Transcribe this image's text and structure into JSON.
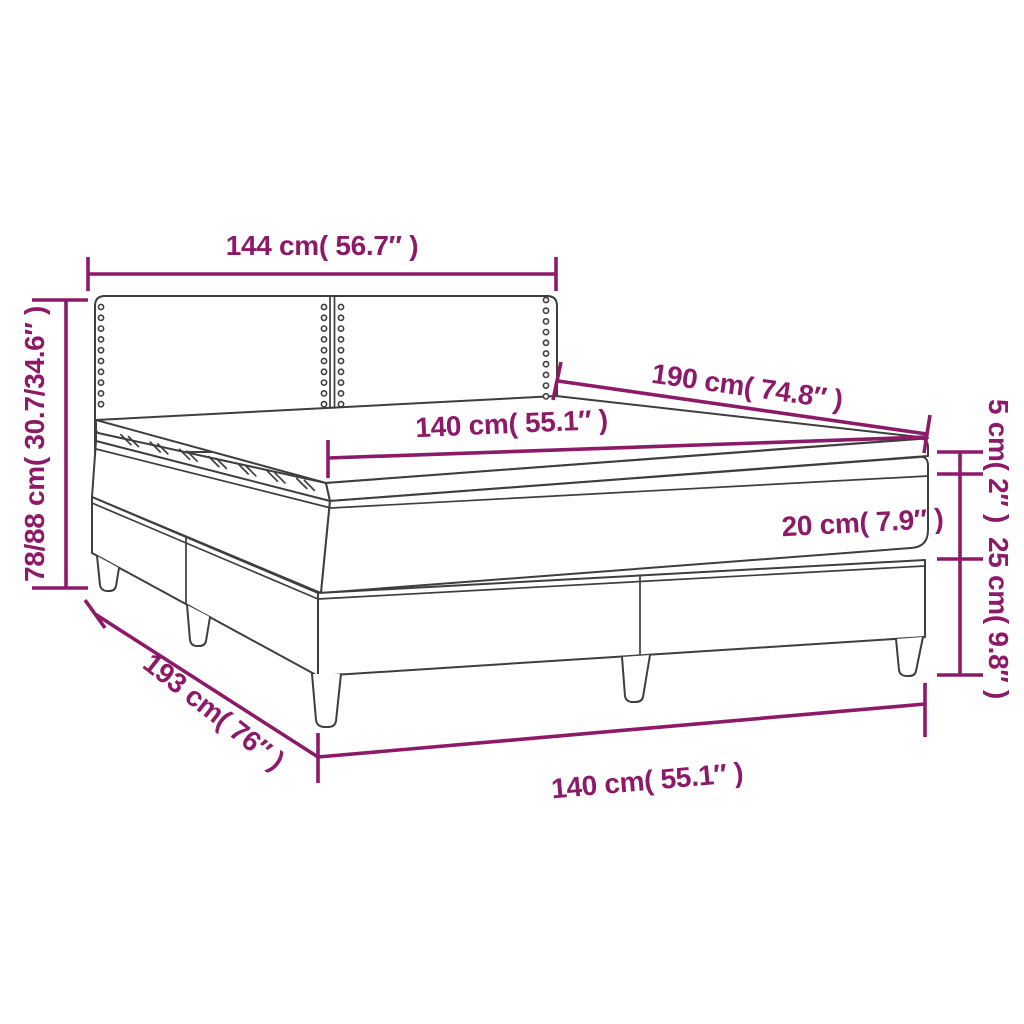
{
  "diagram": {
    "description": "Box spring bed with headboard, mattress and topper - dimension diagram",
    "colors": {
      "dimension_color": "#8d1a69",
      "line_color": "#3e3e3e",
      "background": "#ffffff"
    },
    "labels": {
      "headboard_width": "144 cm( 56.7″ )",
      "total_height": "78/88 cm( 30.7/34.6″ )",
      "bed_length": "190 cm( 74.8″ )",
      "mattress_width": "140 cm( 55.1″ )",
      "topper_thickness": "5 cm( 2″ )",
      "mattress_thickness": "20 cm( 7.9″ )",
      "base_height": "25 cm( 9.8″ )",
      "base_length": "193 cm( 76″ )",
      "base_width": "140 cm( 55.1″ )"
    }
  }
}
